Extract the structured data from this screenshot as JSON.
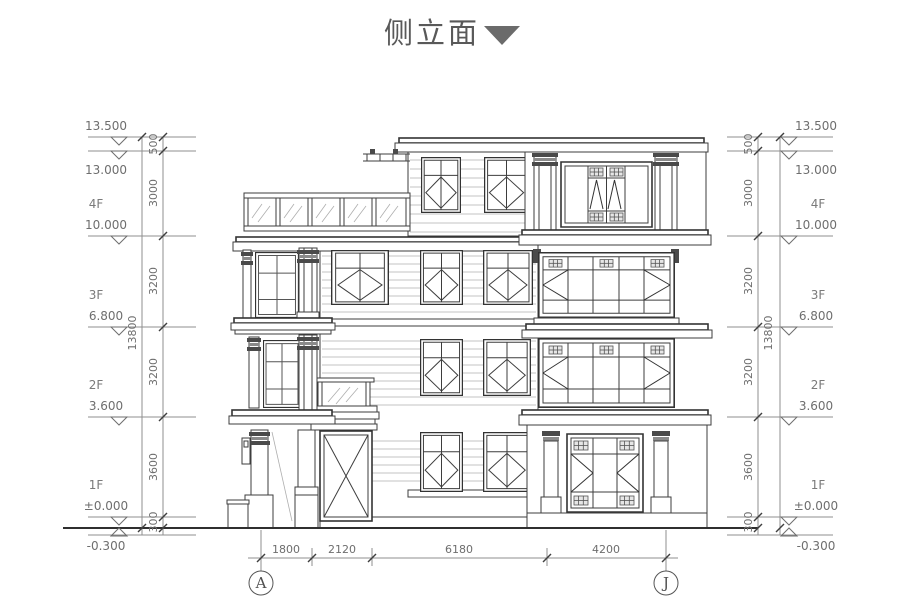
{
  "title": {
    "text": "侧立面"
  },
  "levels": [
    {
      "elevation": "13.500",
      "floor": ""
    },
    {
      "elevation": "13.000",
      "floor": ""
    },
    {
      "elevation": "10.000",
      "floor": "4F"
    },
    {
      "elevation": "6.800",
      "floor": "3F"
    },
    {
      "elevation": "3.600",
      "floor": "2F"
    },
    {
      "elevation": "±0.000",
      "floor": "1F"
    },
    {
      "elevation": "-0.300",
      "floor": ""
    }
  ],
  "vertical_dims": {
    "segments": [
      "500",
      "3000",
      "3200",
      "3200",
      "3600",
      "300"
    ],
    "total": "13800"
  },
  "bottom_dims": {
    "segments": [
      "1800",
      "2120",
      "6180",
      "4200"
    ]
  },
  "grid_labels": [
    "A",
    "J"
  ]
}
